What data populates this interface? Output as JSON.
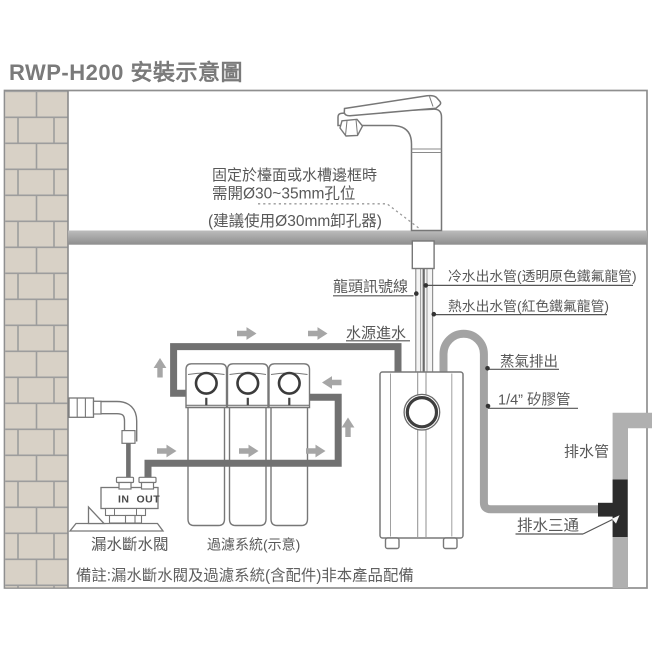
{
  "title": "RWP-H200 安裝示意圖",
  "labels": {
    "mount_line1": "固定於檯面或水槽邊框時",
    "mount_line2": "需開Ø30~35mm孔位",
    "mount_line3": "(建議使用Ø30mm卸孔器)",
    "faucet_signal_cable": "龍頭訊號線",
    "cold_water_out": "冷水出水管(透明原色鐵氟龍管)",
    "hot_water_out": "熱水出水管(紅色鐵氟龍管)",
    "water_source_in": "水源進水",
    "steam_exhaust": "蒸氣排出",
    "silicone_tube": "1/4” 矽膠管",
    "drain_pipe": "排水管",
    "drain_tee": "排水三通",
    "leak_stop_valve": "漏水斷水閥",
    "filter_system": "過濾系統(示意)",
    "valve_in": "IN",
    "valve_out": "OUT",
    "footnote": "備註:漏水斷水閥及過濾系統(含配件)非本產品配備"
  },
  "colors": {
    "title_text": "#7a7a7a",
    "label_text": "#585858",
    "outline": "#777777",
    "brick_fill": "#d8d1c6",
    "mortar_line": "#9d9d9d",
    "counter_top": "#bcbcbc",
    "counter_bottom": "#8e8e8e",
    "water_pipe": "#717171",
    "steam_tube": "#a3a3a3",
    "drain_pipe": "#b0b0b0",
    "drain_tee": "#2c2c2c",
    "arrow": "#a6a6a6"
  }
}
